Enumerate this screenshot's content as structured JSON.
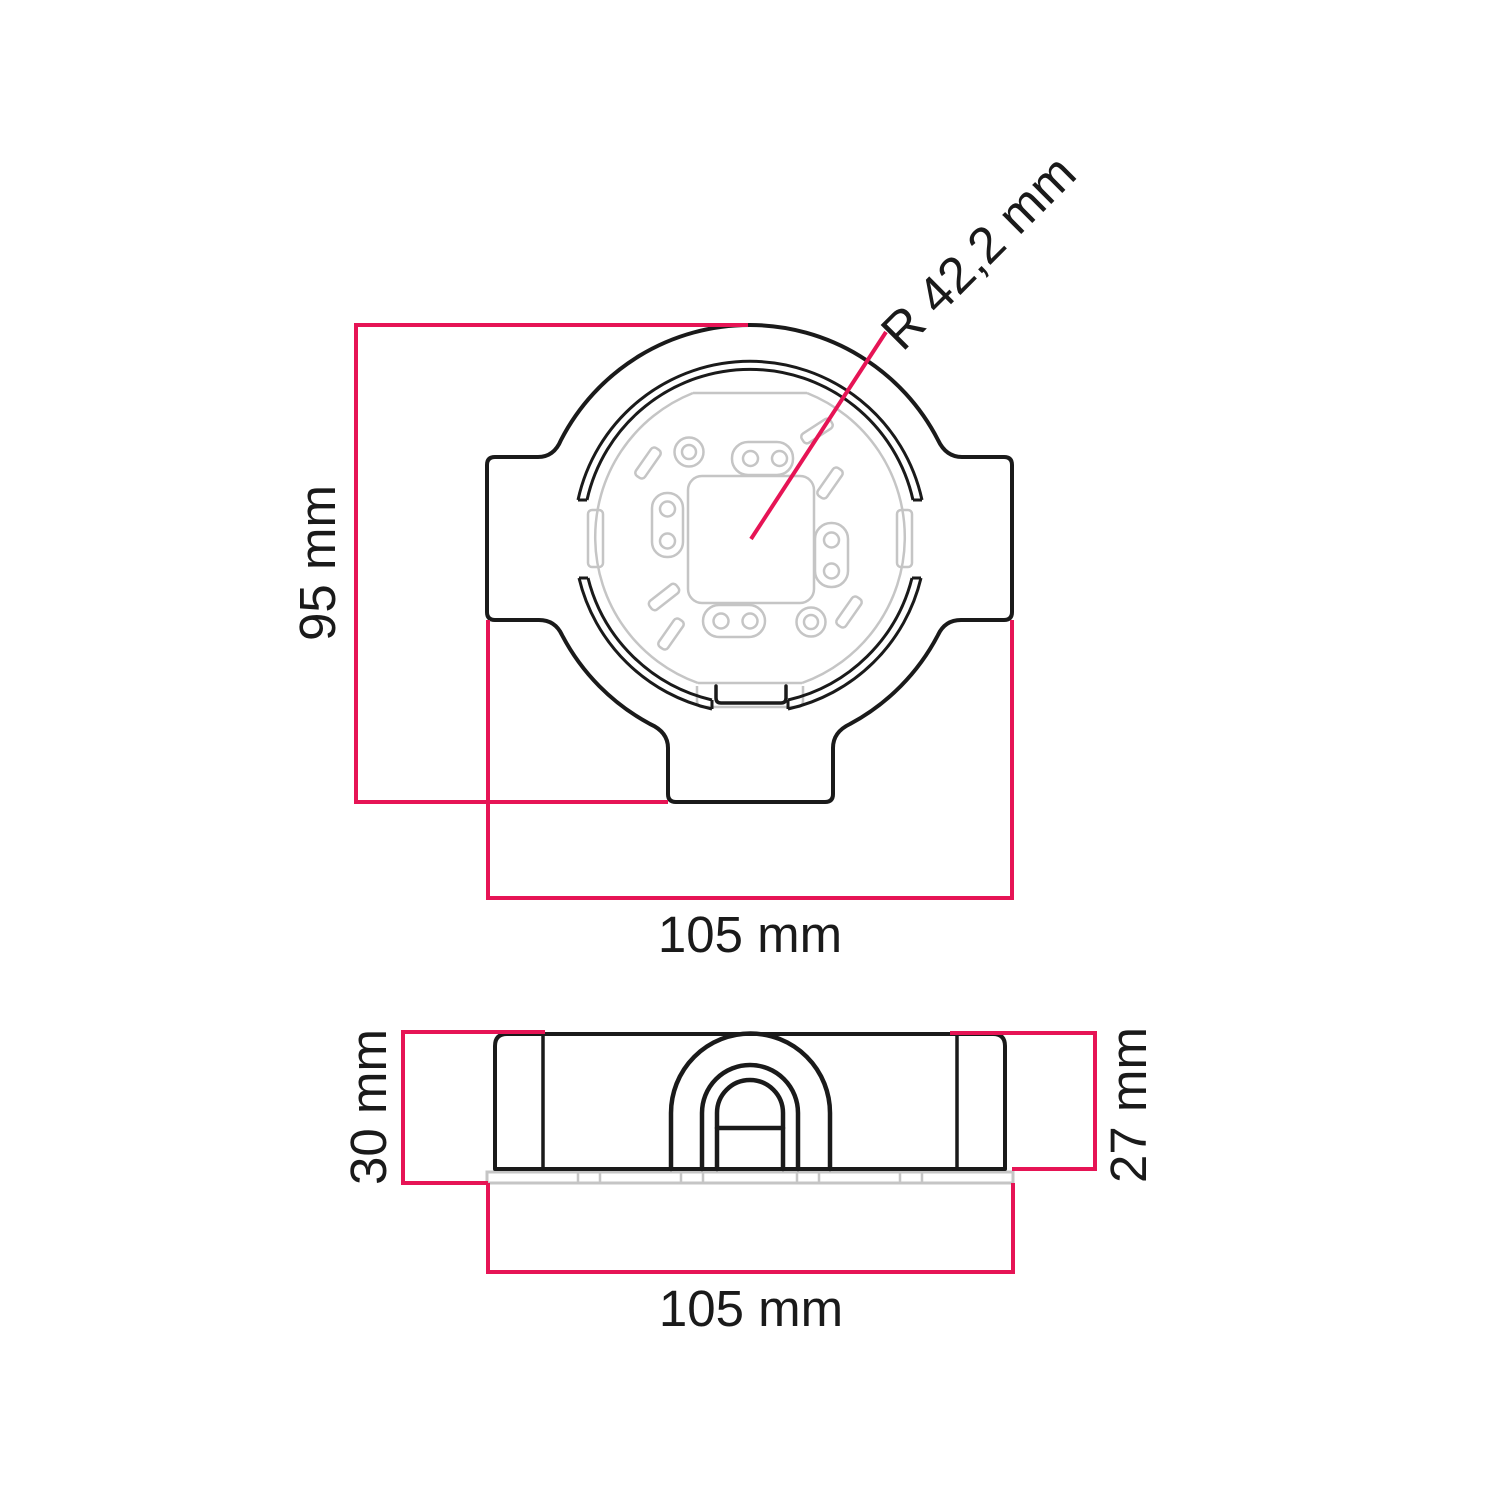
{
  "drawing": {
    "type": "technical-dimension-drawing",
    "colors": {
      "line": "#1a1a1a",
      "dimension": "#e61455",
      "detail_gray": "#c5c5c5",
      "background": "#ffffff"
    },
    "top_view": {
      "height_label": "95 mm",
      "width_label": "105 mm",
      "radius_label": "R 42,2 mm"
    },
    "side_view": {
      "left_height_label": "30 mm",
      "right_height_label": "27 mm",
      "width_label": "105 mm"
    }
  }
}
